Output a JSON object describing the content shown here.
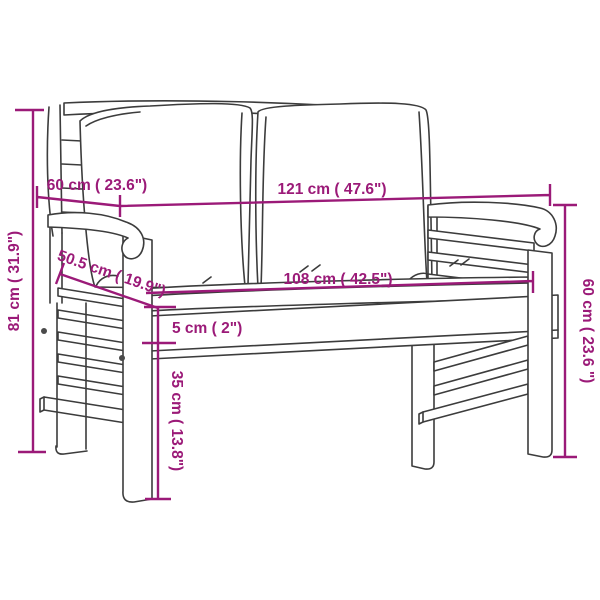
{
  "diagram": {
    "type": "furniture-dimension-diagram",
    "illustration": "line-art garden bench with two back pillows and seat cushion",
    "labels": {
      "arm_depth": "60 cm ( 23.6\")",
      "total_width": "121 cm ( 47.6\")",
      "total_height": "81 cm ( 31.9\")",
      "seat_depth": "50.5 cm ( 19.9\")",
      "seat_width": "108 cm ( 42.5\")",
      "cushion_thickness": "5 cm ( 2\")",
      "seat_height": "35 cm ( 13.8\")",
      "armrest_height": "60 cm ( 23.6 \")"
    },
    "colors": {
      "dimension_lines": "#9B1A78",
      "artwork_lines": "#3C3C3C",
      "background": "#FFFFFF"
    }
  }
}
